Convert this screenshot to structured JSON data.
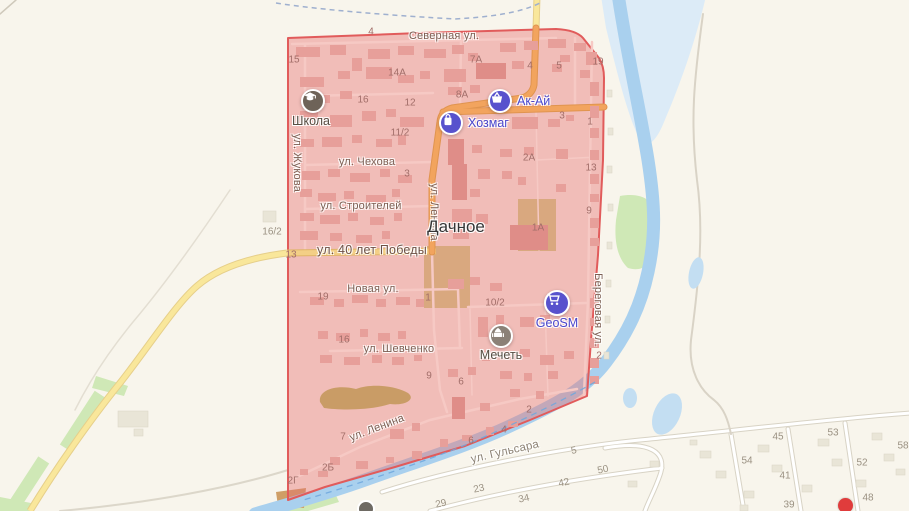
{
  "map": {
    "place_label": "Дачное",
    "streets": {
      "severnaya": "Северная ул.",
      "zhukova": "ул. Жукова",
      "chekhova": "ул. Чехова",
      "lenina": "ул. Ленина",
      "stroiteley": "ул. Строителей",
      "pobedy": "ул. 40 лет Победы",
      "novaya": "Новая ул.",
      "shevchenko": "ул. Шевченко",
      "lenina_south": "ул. Ленина",
      "gulsara": "ул. Гульсара",
      "beregovaya": "Береговая ул."
    },
    "pois": {
      "school": {
        "label": "Школа",
        "icon": "graduation-cap-icon"
      },
      "akay": {
        "label": "Ак-Ай",
        "icon": "basket-icon"
      },
      "khozmag": {
        "label": "Хозмаг",
        "icon": "shopping-bag-icon"
      },
      "geosm": {
        "label": "GeoSM",
        "icon": "shopping-cart-icon"
      },
      "mosque": {
        "label": "Мечеть",
        "icon": "mosque-icon"
      }
    },
    "house_numbers": [
      {
        "t": "4",
        "x": 371,
        "y": 32,
        "zone": "in"
      },
      {
        "t": "15",
        "x": 294,
        "y": 60,
        "zone": "in"
      },
      {
        "t": "14А",
        "x": 397,
        "y": 73,
        "zone": "in"
      },
      {
        "t": "7А",
        "x": 476,
        "y": 60,
        "zone": "in"
      },
      {
        "t": "16",
        "x": 363,
        "y": 100,
        "zone": "in"
      },
      {
        "t": "12",
        "x": 410,
        "y": 103,
        "zone": "in"
      },
      {
        "t": "8А",
        "x": 462,
        "y": 95,
        "zone": "in"
      },
      {
        "t": "4",
        "x": 530,
        "y": 66,
        "zone": "in"
      },
      {
        "t": "5",
        "x": 559,
        "y": 66,
        "zone": "in"
      },
      {
        "t": "19",
        "x": 598,
        "y": 62,
        "zone": "in"
      },
      {
        "t": "11/2",
        "x": 400,
        "y": 133,
        "zone": "in"
      },
      {
        "t": "3",
        "x": 562,
        "y": 116,
        "zone": "in"
      },
      {
        "t": "1",
        "x": 590,
        "y": 122,
        "zone": "in"
      },
      {
        "t": "2А",
        "x": 529,
        "y": 158,
        "zone": "in"
      },
      {
        "t": "13",
        "x": 591,
        "y": 168,
        "zone": "in"
      },
      {
        "t": "3",
        "x": 407,
        "y": 174,
        "zone": "in"
      },
      {
        "t": "9",
        "x": 589,
        "y": 211,
        "zone": "in"
      },
      {
        "t": "1А",
        "x": 538,
        "y": 228,
        "zone": "in"
      },
      {
        "t": "13",
        "x": 291,
        "y": 255,
        "zone": "in"
      },
      {
        "t": "19",
        "x": 323,
        "y": 297,
        "zone": "in"
      },
      {
        "t": "1",
        "x": 428,
        "y": 298,
        "zone": "in"
      },
      {
        "t": "10/2",
        "x": 495,
        "y": 303,
        "zone": "in"
      },
      {
        "t": "16",
        "x": 344,
        "y": 340,
        "zone": "in"
      },
      {
        "t": "2",
        "x": 599,
        "y": 356,
        "zone": "in"
      },
      {
        "t": "9",
        "x": 429,
        "y": 376,
        "zone": "in"
      },
      {
        "t": "6",
        "x": 461,
        "y": 382,
        "zone": "in"
      },
      {
        "t": "2",
        "x": 529,
        "y": 410,
        "zone": "in"
      },
      {
        "t": "4",
        "x": 504,
        "y": 430,
        "zone": "in"
      },
      {
        "t": "6",
        "x": 471,
        "y": 441,
        "zone": "in"
      },
      {
        "t": "7",
        "x": 343,
        "y": 437,
        "zone": "in"
      },
      {
        "t": "2Б",
        "x": 328,
        "y": 468,
        "zone": "in"
      },
      {
        "t": "2Г",
        "x": 293,
        "y": 481,
        "zone": "in"
      },
      {
        "t": "16/2",
        "x": 272,
        "y": 232,
        "zone": "out"
      },
      {
        "t": "5",
        "x": 574,
        "y": 451,
        "zone": "out",
        "r": -12
      },
      {
        "t": "50",
        "x": 603,
        "y": 470,
        "zone": "out",
        "r": -12
      },
      {
        "t": "23",
        "x": 479,
        "y": 489,
        "zone": "out",
        "r": -12
      },
      {
        "t": "42",
        "x": 564,
        "y": 483,
        "zone": "out",
        "r": -12
      },
      {
        "t": "34",
        "x": 524,
        "y": 499,
        "zone": "out",
        "r": -12
      },
      {
        "t": "29",
        "x": 441,
        "y": 504,
        "zone": "out",
        "r": -12
      },
      {
        "t": "45",
        "x": 778,
        "y": 437,
        "zone": "out"
      },
      {
        "t": "53",
        "x": 833,
        "y": 433,
        "zone": "out"
      },
      {
        "t": "58",
        "x": 903,
        "y": 446,
        "zone": "out"
      },
      {
        "t": "54",
        "x": 747,
        "y": 461,
        "zone": "out"
      },
      {
        "t": "52",
        "x": 862,
        "y": 463,
        "zone": "out"
      },
      {
        "t": "41",
        "x": 785,
        "y": 476,
        "zone": "out"
      },
      {
        "t": "39",
        "x": 789,
        "y": 505,
        "zone": "out"
      },
      {
        "t": "48",
        "x": 868,
        "y": 498,
        "zone": "out"
      }
    ],
    "colors": {
      "selection_fill": "#f1b2ae",
      "selection_border": "#e15b5b",
      "river": "#a9d0ee",
      "floodplain": "#dcebf7",
      "green": "#cfe8b6",
      "road_orange": "#f2a45e",
      "road_yellow": "#f9e79b",
      "poi_blue": "#5852cd",
      "background": "#f8f5ec"
    }
  }
}
